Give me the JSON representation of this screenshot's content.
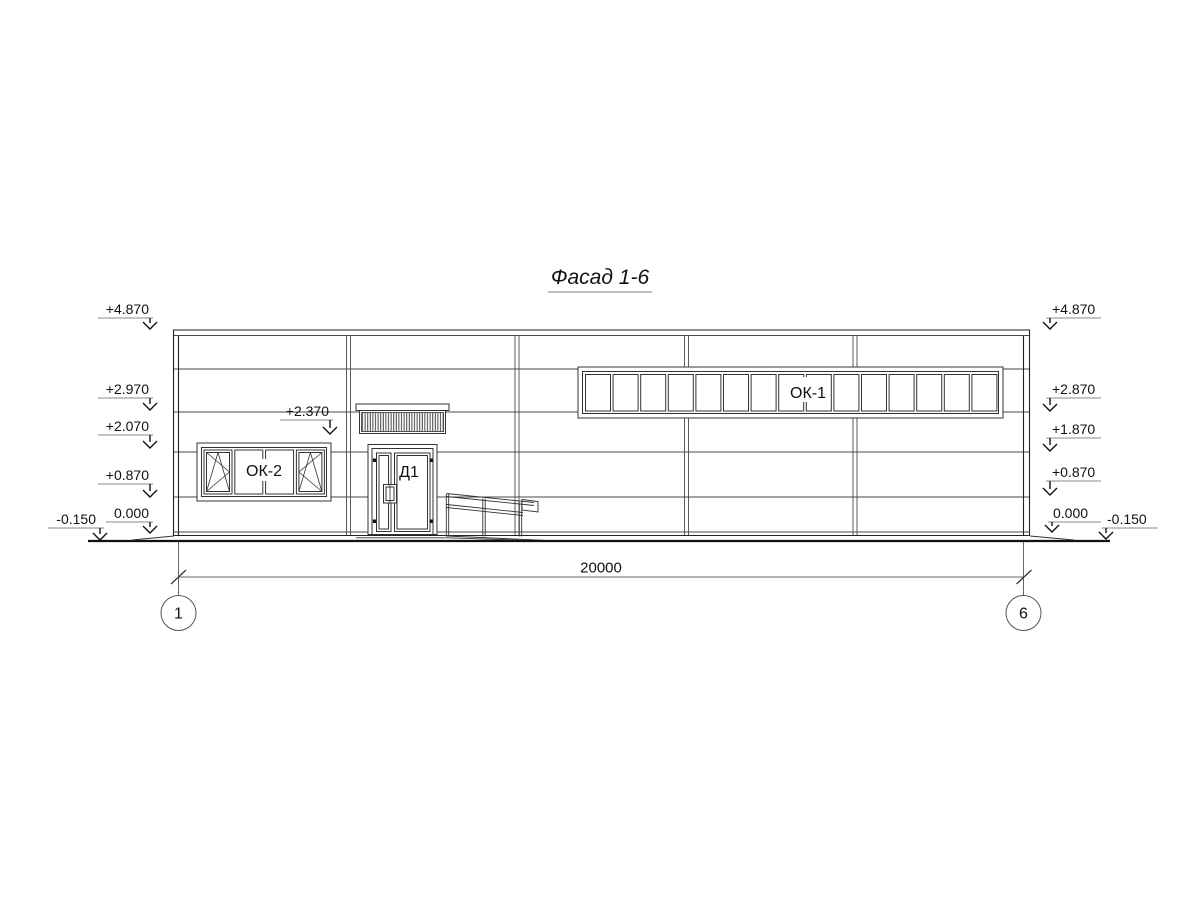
{
  "title": "Фасад 1-6",
  "labels": {
    "window_ribbon": "ОК-1",
    "window_left": "ОК-2",
    "door": "Д1"
  },
  "elevation": {
    "left": [
      "+4.870",
      "+2.970",
      "+2.070",
      "+0.870",
      "0.000",
      "-0.150"
    ],
    "right": [
      "+4.870",
      "+2.870",
      "+1.870",
      "+0.870",
      "0.000",
      "-0.150"
    ],
    "canopy": "+2.370"
  },
  "dimension": {
    "total": "20000"
  },
  "axes": {
    "left": "1",
    "right": "6"
  },
  "colors": {
    "line": "#222222",
    "panel_line": "#4a4a4a",
    "background": "#ffffff"
  }
}
